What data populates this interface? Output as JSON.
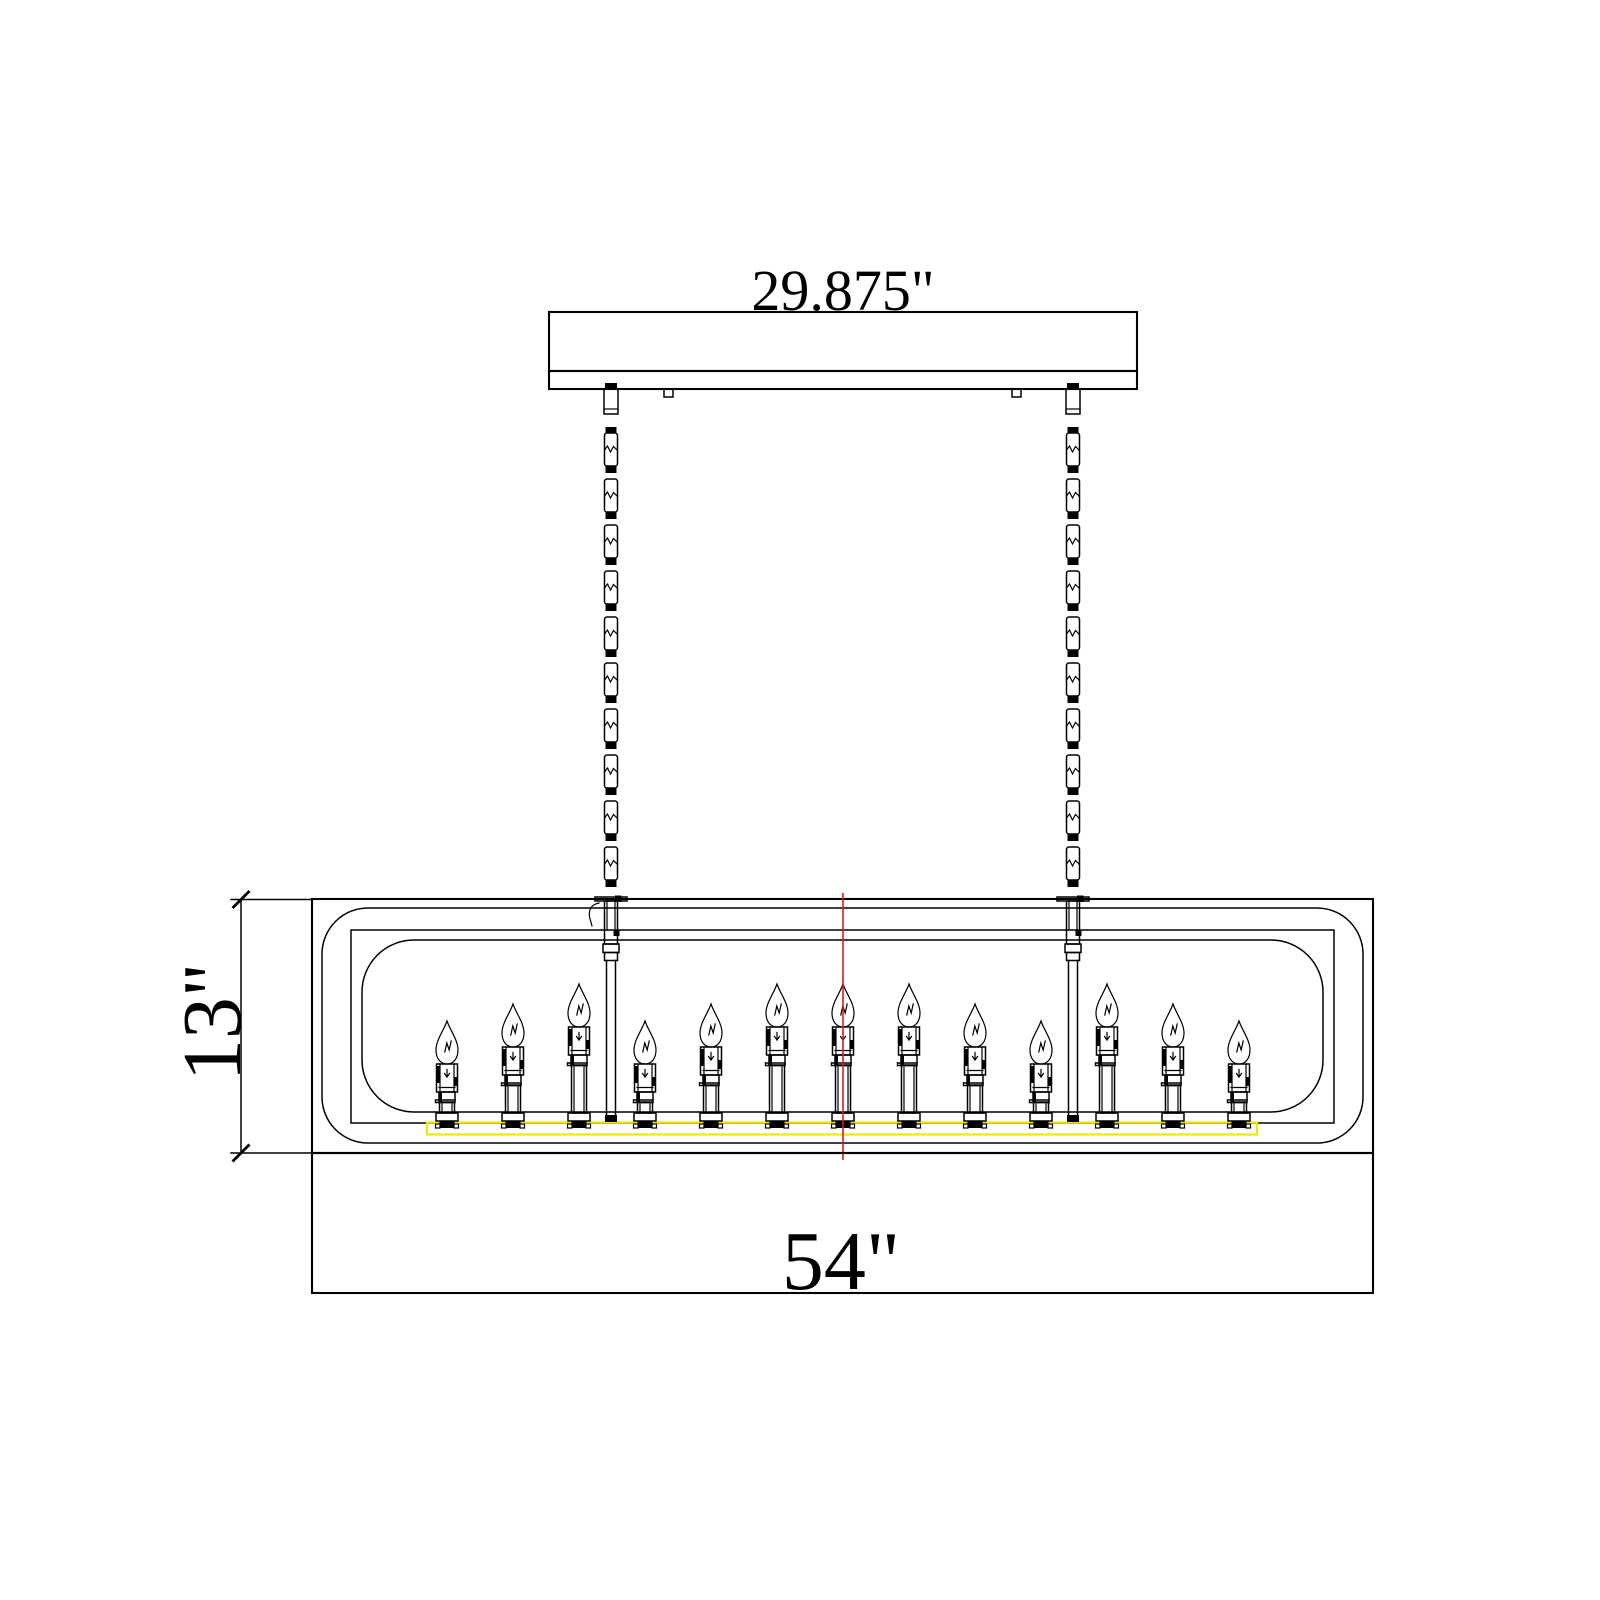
{
  "drawing": {
    "type": "chandelier dimension drawing",
    "view": "front elevation"
  },
  "dimensions": {
    "canopy_width": "29.875\"",
    "fixture_height": "13\"",
    "fixture_width": "54\""
  },
  "fixture": {
    "lights_count": 13,
    "light_positions_x": [
      447,
      513,
      579,
      645,
      711,
      777,
      843,
      909,
      975,
      1041,
      1107,
      1173,
      1239
    ],
    "light_height_classes": [
      "short",
      "medium",
      "tall",
      "short",
      "medium",
      "tall",
      "tall",
      "tall",
      "medium",
      "short",
      "tall",
      "medium",
      "short"
    ],
    "chain_positions_x": [
      611,
      1073
    ]
  },
  "colors": {
    "line": "#000000",
    "accent_strip": "#f0e800",
    "center_line": "#cc2222",
    "background": "#ffffff"
  }
}
